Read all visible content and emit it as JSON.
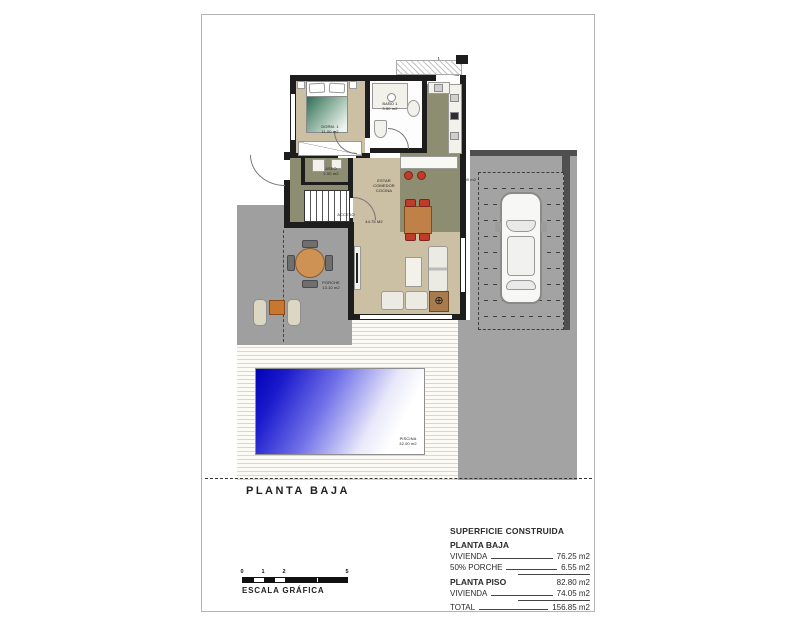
{
  "sheet": {
    "plan_title": "PLANTA BAJA",
    "scale_bar": {
      "ticks": [
        "0",
        "1",
        "2",
        "5"
      ],
      "label": "ESCALA GRÁFICA"
    }
  },
  "plan": {
    "rooms": {
      "dorm1": {
        "name": "DORM. 1",
        "area": "11.00 m2"
      },
      "bano1": {
        "name": "BAÑO 1",
        "area": "3.50 m2"
      },
      "aseo": {
        "name": "ASEO",
        "area": "2.00 m2"
      },
      "estar": {
        "line1": "ESTAR",
        "line2": "COMEDOR",
        "line3": "COCINA",
        "area": "44.75 M2"
      },
      "acceso_label": "ACCESO",
      "porche": {
        "name": "PORCHE",
        "area": "13.10 m2"
      },
      "parking_area": "5.00 m2",
      "piscina": {
        "name": "PISCINA",
        "area": "32.00 m2"
      }
    },
    "icons": {
      "corner_symbol": "⊕"
    }
  },
  "legend": {
    "title": "SUPERFICIE CONSTRUIDA",
    "section1": "PLANTA BAJA",
    "row_vivienda1": {
      "label": "VIVIENDA",
      "value": "76.25 m2"
    },
    "row_porche": {
      "label": "50% PORCHE",
      "value": "6.55 m2"
    },
    "subtotal": "82.80 m2",
    "section2": "PLANTA PISO",
    "row_vivienda2": {
      "label": "VIVIENDA",
      "value": "74.05 m2"
    },
    "row_total": {
      "label": "TOTAL",
      "value": "156.85 m2"
    }
  },
  "colors": {
    "wall": "#1d1d1d",
    "floor_tan": "#cbbfa4",
    "floor_olive": "#8d8e71",
    "terrain_gray": "#9f9f9f",
    "pool_blue": "#0101b6",
    "chair_red": "#c23b28",
    "table_wood": "#bf8148"
  }
}
